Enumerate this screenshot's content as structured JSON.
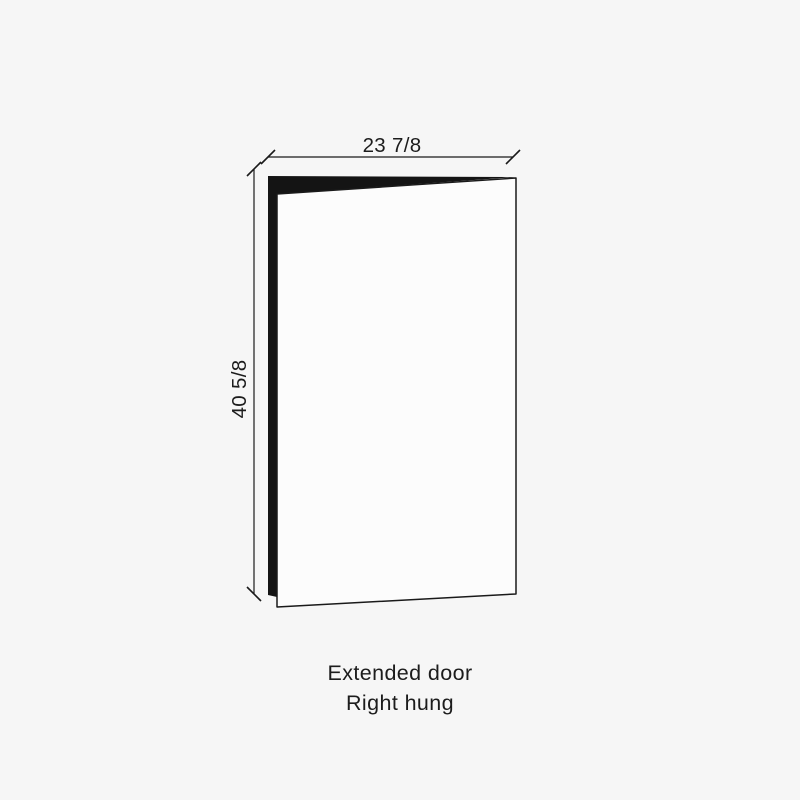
{
  "figure": {
    "dimensions": {
      "width": {
        "label": "23 7/8"
      },
      "height": {
        "label": "40 5/8"
      }
    },
    "caption": {
      "line1": "Extended door",
      "line2": "Right hung"
    },
    "colors": {
      "background": "#f6f6f6",
      "line": "#1a1a1a",
      "text": "#1c1c1c",
      "door_face_fill": "#fcfcfc",
      "door_edge_fill": "#141414"
    }
  }
}
